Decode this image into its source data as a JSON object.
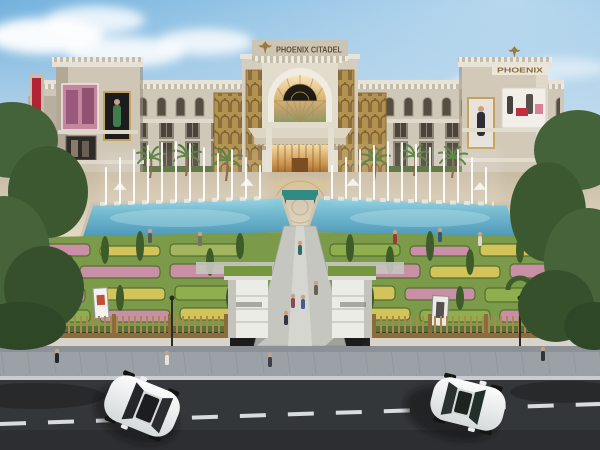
{
  "meta": {
    "title": "Phoenix Citadel mall exterior rendering",
    "image_type": "architectural daylight render, aerial front view"
  },
  "signs": {
    "main": "PHOENIX CITADEL",
    "tower": "PHOENIX"
  },
  "icons": {
    "phoenix_logo": "stylized golden phoenix bird with spread wings"
  },
  "scene": {
    "description": "Symmetric beige art-deco shopping mall facade with golden fan-pattern panels, central arched stained-glass entrance under a canopy, rooftop PHOENIX CITADEL sign with phoenix emblem, end towers carrying fashion billboards, formal parterre flower gardens, two blue fountain pools with vertical water jets, central walkway through a gate of two grass-topped pillars, golden perimeter fence, grey sidewalk with pedestrians, and a dark asphalt road with two white cars.",
    "time_of_day": "daytime",
    "weather": "partly cloudy blue sky",
    "object_counts": {
      "cars": 2,
      "fountain_pools": 2,
      "gate_pillars": 2,
      "billboards": 5,
      "palm_trees": 6
    }
  },
  "colors": {
    "sky_top": "#6fb0dd",
    "sky_horizon": "#e9f0f4",
    "facade": "#cfc7b7",
    "facade_trim": "#e8e3d8",
    "gold_panel": "#b3924f",
    "gold_dark": "#7c5f33",
    "water": "#5aa7c6",
    "garden_green": "#7b9b4a",
    "flower_pink": "#c98fa6",
    "flower_yellow": "#d2c35a",
    "road": "#34373a",
    "sidewalk": "#9ba1a7",
    "fence_gold": "#8a6d3b",
    "car_white": "#f4f6f6",
    "gate_grass": "#74973f",
    "canopy_teal": "#2f8b84",
    "banner_red": "#b22335"
  }
}
